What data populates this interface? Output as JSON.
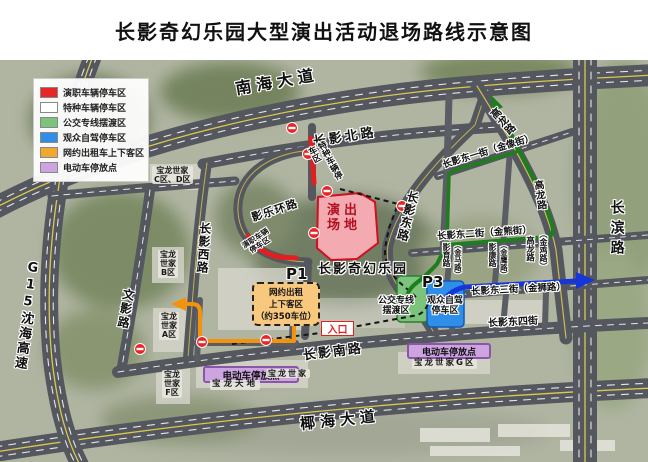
{
  "title": "长影奇幻乐园大型演出活动退场路线示意图",
  "legend": {
    "items": [
      {
        "label": "演职车辆停车区",
        "color": "#e82626"
      },
      {
        "label": "特种车辆停车区",
        "color": "#ffffff"
      },
      {
        "label": "公交专线摆渡区",
        "color": "#7cc47c"
      },
      {
        "label": "观众自驾停车区",
        "color": "#2f8fe8"
      },
      {
        "label": "网约出租车上下客区",
        "color": "#f0a830"
      },
      {
        "label": "电动车停放点",
        "color": "#cda4e0"
      }
    ]
  },
  "roads": {
    "nanhai": "南海大道",
    "yehai": "椰海大道",
    "g15": "G15沈海高速",
    "changbin": "长滨路",
    "changying_north": "长影北路",
    "changying_west": "长影西路",
    "wenying": "文影路",
    "changying_south": "长影南路",
    "changying_east": "长影东路",
    "yingle_ring": "影乐环路",
    "east1": "长影东一街（金像街）",
    "east2": "长影东二街（金熊街）",
    "east3": "长影东三街（金狮路）",
    "east4": "长影东四街",
    "gaolong_top": "高龙路",
    "gaolong_mid": "高龙路",
    "gaolong_s": "高龙路",
    "jinji": "（金鸡路）",
    "yingyu": "影育路",
    "jinma": "（金马路）",
    "yingkang": "影康路",
    "jinying": "（金鹰路）"
  },
  "areas": {
    "venue": "演出\n场地",
    "park": "长影奇幻乐园",
    "p1": "P1",
    "p3": "P3",
    "rideshare_zone": "网约出租\n上下客区\n（约350车位）",
    "bus_zone": "公交专线\n摆渡区",
    "self_drive_zone": "观众自驾\n停车区",
    "ebike_zone": "电动车停放点",
    "entrance": "入口",
    "special_parking": "特种车辆停车区",
    "staff_parking": "演职车辆\n停车区"
  },
  "blocks": {
    "cd": "宝龙世家\nC区、D区",
    "b": "宝龙\n世家\nB区",
    "a": "宝龙\n世家\nA区",
    "f": "宝龙\n世家\nF区",
    "tiandi": "宝龙天地",
    "shijia": "宝龙世家",
    "g": "宝龙世家G区"
  },
  "colors": {
    "staff_red": "#e21f1f",
    "bus_green": "#1e7d1e",
    "self_drive_blue": "#1636d8",
    "rideshare_orange": "#f5920b",
    "road_gray": "#54575e"
  }
}
